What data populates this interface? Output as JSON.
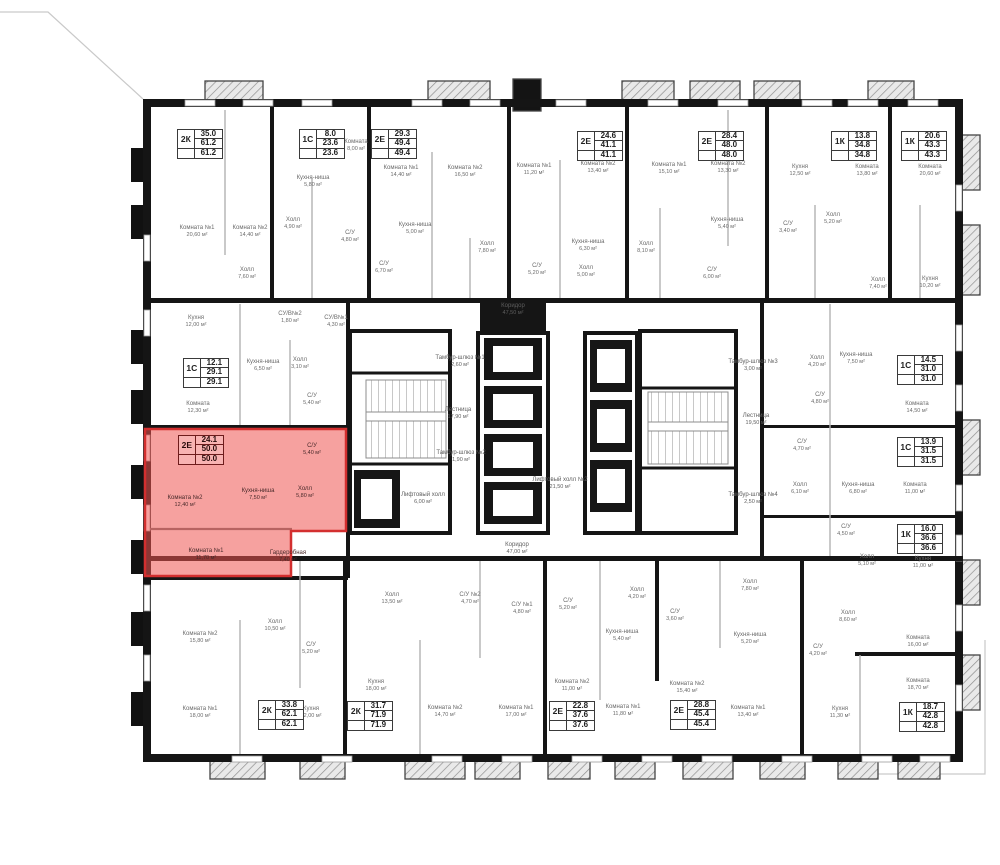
{
  "plan": {
    "units_suffix": "м²",
    "highlight_fill": "#ef5350",
    "highlight_stroke": "#d32f2f",
    "wall_color": "#151515"
  },
  "apartments": [
    {
      "type": "2К",
      "living": "35.0",
      "total": "61.2",
      "total2": "61.2",
      "x": 200,
      "y": 144
    },
    {
      "type": "1С",
      "living": "8.0",
      "total": "23.6",
      "total2": "23.6",
      "x": 322,
      "y": 144
    },
    {
      "type": "2Е",
      "living": "29.3",
      "total": "49.4",
      "total2": "49.4",
      "x": 394,
      "y": 144
    },
    {
      "type": "2Е",
      "living": "24.6",
      "total": "41.1",
      "total2": "41.1",
      "x": 600,
      "y": 146
    },
    {
      "type": "2Е",
      "living": "28.4",
      "total": "48.0",
      "total2": "48.0",
      "x": 721,
      "y": 146
    },
    {
      "type": "1К",
      "living": "13.8",
      "total": "34.8",
      "total2": "34.8",
      "x": 854,
      "y": 146
    },
    {
      "type": "1К",
      "living": "20.6",
      "total": "43.3",
      "total2": "43.3",
      "x": 924,
      "y": 146
    },
    {
      "type": "1С",
      "living": "12.1",
      "total": "29.1",
      "total2": "29.1",
      "x": 206,
      "y": 373
    },
    {
      "type": "2Е",
      "living": "24.1",
      "total": "50.0",
      "total2": "50.0",
      "x": 201,
      "y": 450,
      "highlighted": true
    },
    {
      "type": "1С",
      "living": "14.5",
      "total": "31.0",
      "total2": "31.0",
      "x": 920,
      "y": 370
    },
    {
      "type": "1С",
      "living": "13.9",
      "total": "31.5",
      "total2": "31.5",
      "x": 920,
      "y": 452
    },
    {
      "type": "1К",
      "living": "16.0",
      "total": "36.6",
      "total2": "36.6",
      "x": 920,
      "y": 539
    },
    {
      "type": "2К",
      "living": "33.8",
      "total": "62.1",
      "total2": "62.1",
      "x": 281,
      "y": 715
    },
    {
      "type": "2К",
      "living": "31.7",
      "total": "71.9",
      "total2": "71.9",
      "x": 370,
      "y": 716
    },
    {
      "type": "2Е",
      "living": "22.8",
      "total": "37.6",
      "total2": "37.6",
      "x": 572,
      "y": 716
    },
    {
      "type": "2Е",
      "living": "28.8",
      "total": "45.4",
      "total2": "45.4",
      "x": 693,
      "y": 715
    },
    {
      "type": "1К",
      "living": "18.7",
      "total": "42.8",
      "total2": "42.8",
      "x": 922,
      "y": 717
    }
  ],
  "rooms": [
    {
      "name": "Комната №1",
      "area": "20,60 м²",
      "x": 197,
      "y": 232
    },
    {
      "name": "Комната №2",
      "area": "14,40 м²",
      "x": 250,
      "y": 232
    },
    {
      "name": "Холл",
      "area": "7,60 м²",
      "x": 247,
      "y": 274
    },
    {
      "name": "Кухня",
      "area": "12,00 м²",
      "x": 196,
      "y": 322
    },
    {
      "name": "СУ/В№2",
      "area": "1,80 м²",
      "x": 290,
      "y": 318
    },
    {
      "name": "СУ/В№1",
      "area": "4,30 м²",
      "x": 336,
      "y": 322
    },
    {
      "name": "Комната",
      "area": "8,00 м²",
      "x": 356,
      "y": 146
    },
    {
      "name": "Кухня-ниша",
      "area": "5,80 м²",
      "x": 313,
      "y": 182
    },
    {
      "name": "Холл",
      "area": "4,90 м²",
      "x": 293,
      "y": 224
    },
    {
      "name": "С/У",
      "area": "4,80 м²",
      "x": 350,
      "y": 237
    },
    {
      "name": "С/У",
      "area": "6,70 м²",
      "x": 384,
      "y": 268
    },
    {
      "name": "Комната №1",
      "area": "14,40 м²",
      "x": 401,
      "y": 172
    },
    {
      "name": "Комната №2",
      "area": "16,50 м²",
      "x": 465,
      "y": 172
    },
    {
      "name": "Кухня-ниша",
      "area": "5,00 м²",
      "x": 415,
      "y": 229
    },
    {
      "name": "Холл",
      "area": "7,80 м²",
      "x": 487,
      "y": 248
    },
    {
      "name": "Комната №1",
      "area": "11,20 м²",
      "x": 534,
      "y": 170
    },
    {
      "name": "С/У",
      "area": "5,20 м²",
      "x": 537,
      "y": 270
    },
    {
      "name": "Комната №2",
      "area": "13,40 м²",
      "x": 598,
      "y": 168
    },
    {
      "name": "Кухня-ниша",
      "area": "6,30 м²",
      "x": 588,
      "y": 246
    },
    {
      "name": "Холл",
      "area": "5,00 м²",
      "x": 586,
      "y": 272
    },
    {
      "name": "Комната №1",
      "area": "15,10 м²",
      "x": 669,
      "y": 169
    },
    {
      "name": "Холл",
      "area": "8,10 м²",
      "x": 646,
      "y": 248
    },
    {
      "name": "Комната №2",
      "area": "13,30 м²",
      "x": 728,
      "y": 168
    },
    {
      "name": "Кухня-ниша",
      "area": "5,40 м²",
      "x": 727,
      "y": 224
    },
    {
      "name": "С/У",
      "area": "3,40 м²",
      "x": 788,
      "y": 228
    },
    {
      "name": "С/У",
      "area": "6,00 м²",
      "x": 712,
      "y": 274
    },
    {
      "name": "Кухня",
      "area": "12,50 м²",
      "x": 800,
      "y": 171
    },
    {
      "name": "Холл",
      "area": "5,20 м²",
      "x": 833,
      "y": 219
    },
    {
      "name": "Комната",
      "area": "13,80 м²",
      "x": 867,
      "y": 171
    },
    {
      "name": "Комната",
      "area": "20,60 м²",
      "x": 930,
      "y": 171
    },
    {
      "name": "Холл",
      "area": "7,40 м²",
      "x": 878,
      "y": 284
    },
    {
      "name": "Кухня",
      "area": "10,20 м²",
      "x": 930,
      "y": 283
    },
    {
      "name": "Комната",
      "area": "12,30 м²",
      "x": 198,
      "y": 408
    },
    {
      "name": "Кухня-ниша",
      "area": "6,50 м²",
      "x": 263,
      "y": 366
    },
    {
      "name": "Холл",
      "area": "3,10 м²",
      "x": 300,
      "y": 364
    },
    {
      "name": "С/У",
      "area": "5,40 м²",
      "x": 312,
      "y": 400
    },
    {
      "name": "Комната №2",
      "area": "12,40 м²",
      "x": 185,
      "y": 502,
      "highlighted": true
    },
    {
      "name": "Кухня-ниша",
      "area": "7,50 м²",
      "x": 258,
      "y": 495,
      "highlighted": true
    },
    {
      "name": "Холл",
      "area": "5,80 м²",
      "x": 305,
      "y": 493,
      "highlighted": true
    },
    {
      "name": "С/У",
      "area": "5,40 м²",
      "x": 312,
      "y": 450,
      "highlighted": true
    },
    {
      "name": "Комната №1",
      "area": "11,70 м²",
      "x": 206,
      "y": 555,
      "highlighted": true
    },
    {
      "name": "Гардеробная",
      "area": "7,40 м²",
      "x": 288,
      "y": 557,
      "highlighted": true
    },
    {
      "name": "Холл",
      "area": "4,20 м²",
      "x": 817,
      "y": 362
    },
    {
      "name": "Кухня-ниша",
      "area": "7,50 м²",
      "x": 856,
      "y": 359
    },
    {
      "name": "С/У",
      "area": "4,80 м²",
      "x": 820,
      "y": 399
    },
    {
      "name": "Комната",
      "area": "14,50 м²",
      "x": 917,
      "y": 408
    },
    {
      "name": "С/У",
      "area": "4,70 м²",
      "x": 802,
      "y": 446
    },
    {
      "name": "Холл",
      "area": "6,10 м²",
      "x": 800,
      "y": 489
    },
    {
      "name": "Кухня-ниша",
      "area": "6,80 м²",
      "x": 858,
      "y": 489
    },
    {
      "name": "Комната",
      "area": "11,00 м²",
      "x": 915,
      "y": 489
    },
    {
      "name": "С/У",
      "area": "4,50 м²",
      "x": 846,
      "y": 531
    },
    {
      "name": "Холл",
      "area": "5,10 м²",
      "x": 867,
      "y": 561
    },
    {
      "name": "Кухня",
      "area": "11,00 м²",
      "x": 923,
      "y": 563
    },
    {
      "name": "Комната",
      "area": "16,00 м²",
      "x": 918,
      "y": 642
    },
    {
      "name": "Холл",
      "area": "8,60 м²",
      "x": 848,
      "y": 617
    },
    {
      "name": "С/У",
      "area": "4,20 м²",
      "x": 818,
      "y": 651
    },
    {
      "name": "Комната",
      "area": "18,70 м²",
      "x": 918,
      "y": 685
    },
    {
      "name": "Кухня",
      "area": "11,30 м²",
      "x": 840,
      "y": 713
    },
    {
      "name": "Комната №2",
      "area": "15,80 м²",
      "x": 200,
      "y": 638
    },
    {
      "name": "Комната №1",
      "area": "18,00 м²",
      "x": 200,
      "y": 713
    },
    {
      "name": "Холл",
      "area": "10,50 м²",
      "x": 275,
      "y": 626
    },
    {
      "name": "С/У",
      "area": "5,20 м²",
      "x": 311,
      "y": 649
    },
    {
      "name": "Кухня",
      "area": "12,00 м²",
      "x": 311,
      "y": 713
    },
    {
      "name": "Холл",
      "area": "13,50 м²",
      "x": 392,
      "y": 599
    },
    {
      "name": "С/У №2",
      "area": "4,70 м²",
      "x": 470,
      "y": 599
    },
    {
      "name": "С/У №1",
      "area": "4,80 м²",
      "x": 522,
      "y": 609
    },
    {
      "name": "Кухня",
      "area": "18,00 м²",
      "x": 376,
      "y": 686
    },
    {
      "name": "Комната №2",
      "area": "14,70 м²",
      "x": 445,
      "y": 712
    },
    {
      "name": "Комната №1",
      "area": "17,00 м²",
      "x": 516,
      "y": 712
    },
    {
      "name": "С/У",
      "area": "5,20 м²",
      "x": 568,
      "y": 605
    },
    {
      "name": "Комната №2",
      "area": "11,00 м²",
      "x": 572,
      "y": 686
    },
    {
      "name": "Холл",
      "area": "4,20 м²",
      "x": 637,
      "y": 594
    },
    {
      "name": "Кухня-ниша",
      "area": "5,40 м²",
      "x": 622,
      "y": 636
    },
    {
      "name": "Комната №1",
      "area": "11,80 м²",
      "x": 623,
      "y": 711
    },
    {
      "name": "С/У",
      "area": "3,60 м²",
      "x": 675,
      "y": 616
    },
    {
      "name": "Комната №2",
      "area": "15,40 м²",
      "x": 687,
      "y": 688
    },
    {
      "name": "Холл",
      "area": "7,80 м²",
      "x": 750,
      "y": 586
    },
    {
      "name": "Кухня-ниша",
      "area": "5,20 м²",
      "x": 750,
      "y": 639
    },
    {
      "name": "Комната №1",
      "area": "13,40 м²",
      "x": 748,
      "y": 712
    }
  ],
  "cores": [
    {
      "name": "Коридор",
      "area": "47,50 м²",
      "x": 513,
      "y": 310
    },
    {
      "name": "Тамбур-шлюз №1",
      "area": "2,60 м²",
      "x": 460,
      "y": 362
    },
    {
      "name": "Лестница",
      "area": "17,90 м²",
      "x": 458,
      "y": 414
    },
    {
      "name": "Тамбур-шлюз №2",
      "area": "1,90 м²",
      "x": 461,
      "y": 457
    },
    {
      "name": "Лифтовый холл",
      "area": "6,00 м²",
      "x": 423,
      "y": 499
    },
    {
      "name": "Лифтовый холл №2",
      "area": "21,50 м²",
      "x": 560,
      "y": 484
    },
    {
      "name": "Тамбур-шлюз №3",
      "area": "3,00 м²",
      "x": 753,
      "y": 366
    },
    {
      "name": "Лестница",
      "area": "19,50 м²",
      "x": 756,
      "y": 420
    },
    {
      "name": "Тамбур-шлюз №4",
      "area": "2,50 м²",
      "x": 753,
      "y": 499
    },
    {
      "name": "Коридор",
      "area": "47,00 м²",
      "x": 517,
      "y": 549
    }
  ]
}
